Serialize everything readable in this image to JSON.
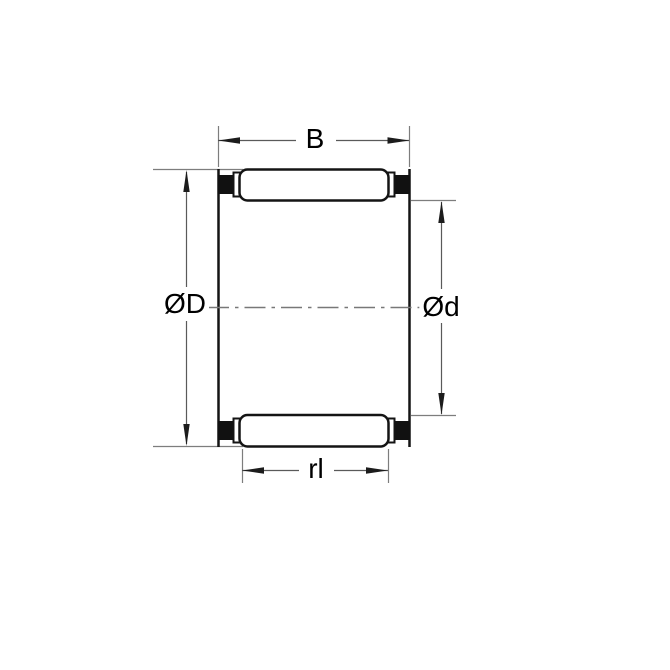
{
  "diagram": {
    "type": "bearing-cross-section-drawing",
    "labels": {
      "width": "B",
      "outer_diameter": "ØD",
      "inner_diameter": "Ød",
      "roller_length": "rl"
    },
    "colors": {
      "background": "#ffffff",
      "geometry_line": "#141414",
      "cage_block_fill": "#111111",
      "dimension_line": "#5a5a5a",
      "extension_line": "#7d7d7d",
      "centerline": "#787878",
      "label_text": "#000000"
    }
  }
}
